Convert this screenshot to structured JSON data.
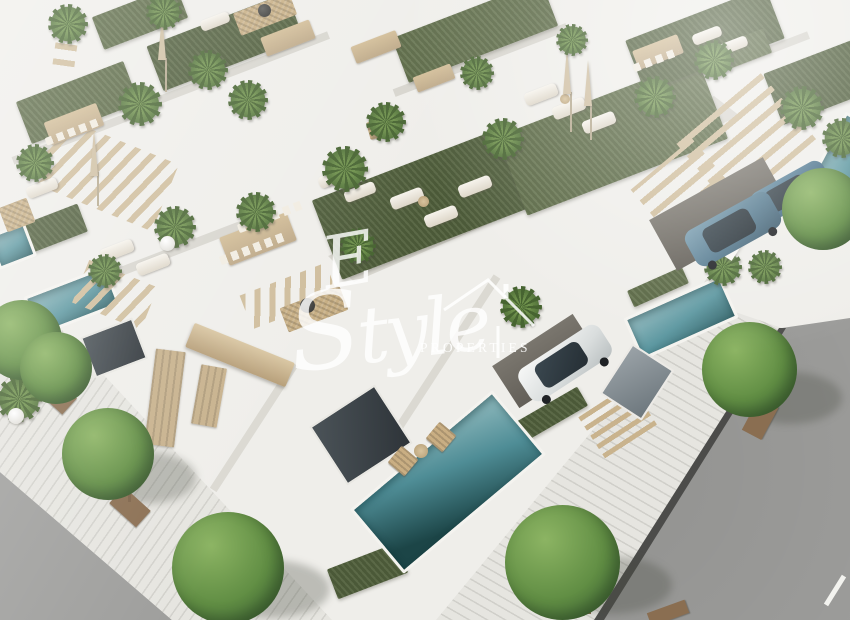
{
  "watermark": {
    "brand_initial": "E",
    "brand_name": "Style",
    "subtitle": "PROPERTIES",
    "color": "#ffffff",
    "icon": "house-outline-icon"
  },
  "scene": {
    "type": "aerial 3D architectural render",
    "subject": "modern white villa development with rooftop terraces, artificial turf, private pools, carports and tree-lined streets",
    "objects": [
      "white villas",
      "rooftop turf terraces",
      "potted palms",
      "sun loungers",
      "dining sets",
      "closed parasols",
      "pergola stairs",
      "private pools",
      "blue suv",
      "teal suv",
      "white hatchback",
      "street trees in planters",
      "sidewalk",
      "asphalt road",
      "rattan rug with fire bowl",
      "wooden deck chairs"
    ]
  },
  "palette": {
    "background": "#efeeea",
    "wall_white": "#f8f7f3",
    "wall_shade": "#d7d5ce",
    "turf_green": "#51603c",
    "tree_green": "#618e44",
    "pool_teal": "#5c97a0",
    "pool_deep": "#1c4547",
    "wood_tan": "#cfbd9c",
    "road_gray": "#9e9e9c",
    "sidewalk": "#e6e5e0",
    "planter_brown": "#8a6e51",
    "car_blue": "#567b90"
  }
}
